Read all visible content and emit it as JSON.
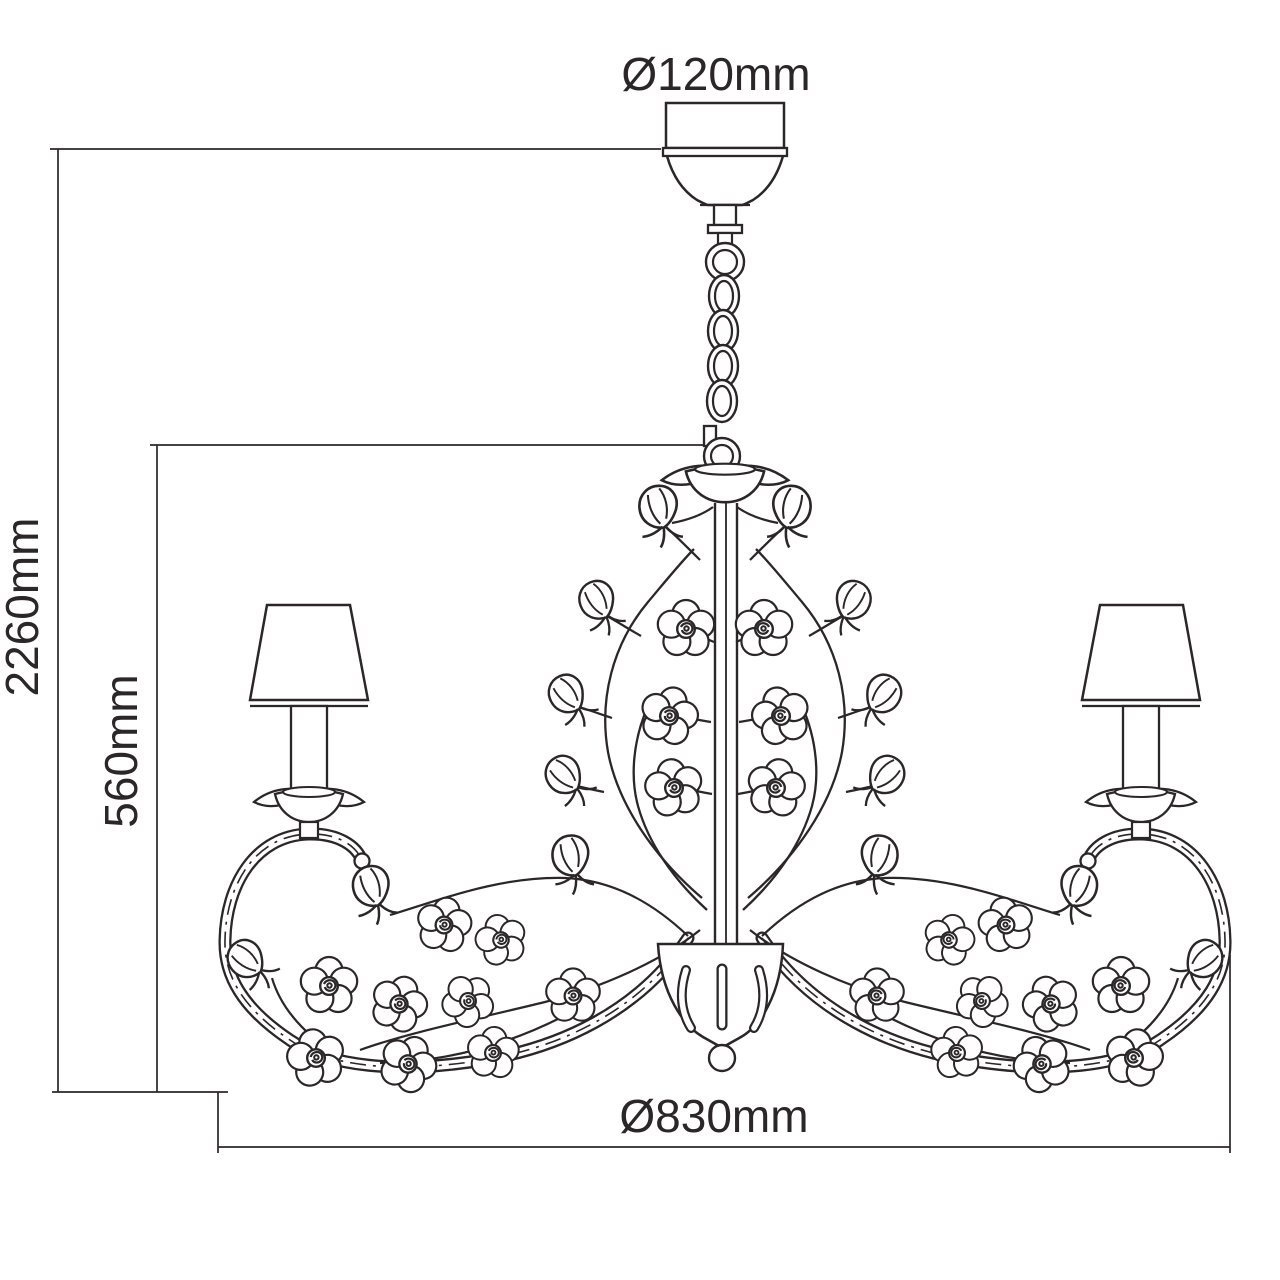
{
  "labels": {
    "canopy_diameter": "Ø120mm",
    "overall_height": "2260mm",
    "body_height": "560mm",
    "body_diameter": "Ø830mm"
  },
  "colors": {
    "line": "#2b2627",
    "background": "#ffffff"
  }
}
